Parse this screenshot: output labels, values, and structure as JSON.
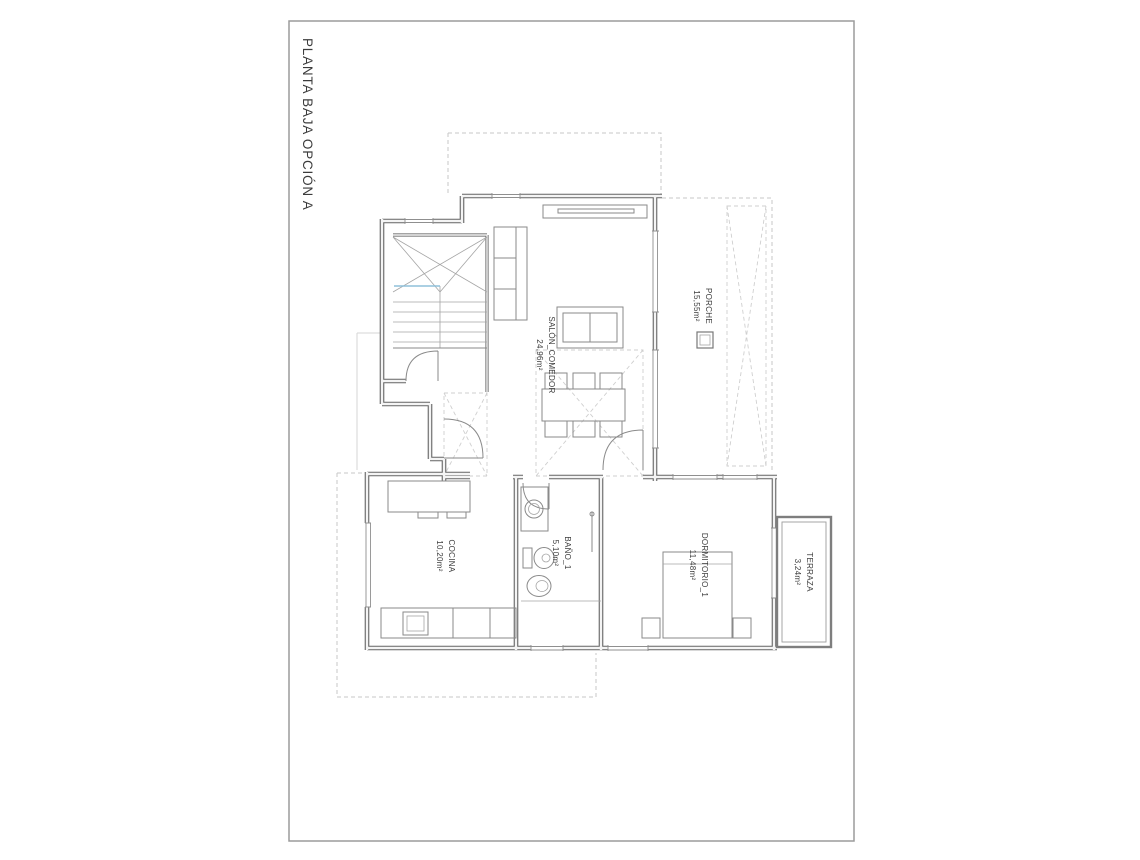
{
  "page": {
    "title": "PLANTA BAJA OPCIÓN A"
  },
  "drawing": {
    "type": "architectural-floor-plan",
    "rooms": {
      "porche": {
        "name": "PORCHE",
        "area": "15,55m²"
      },
      "salon": {
        "name": "SALÓN_COMEDOR",
        "area": "24,96m²"
      },
      "cocina": {
        "name": "COCINA",
        "area": "10,20m²"
      },
      "bano": {
        "name": "BAÑO_1",
        "area": "5,10m²"
      },
      "dormitorio": {
        "name": "DORMITORIO_1",
        "area": "11,48m²"
      },
      "terraza": {
        "name": "TERRAZA",
        "area": "3,24m²"
      }
    },
    "colors": {
      "wall": "#646464",
      "furniture": "#8a8a8a",
      "dashed_outline": "#c7c7c7",
      "stair_section_cut": "#8fc0da",
      "paper_border": "#9b9b9b",
      "text": "#3c3c3c"
    }
  }
}
